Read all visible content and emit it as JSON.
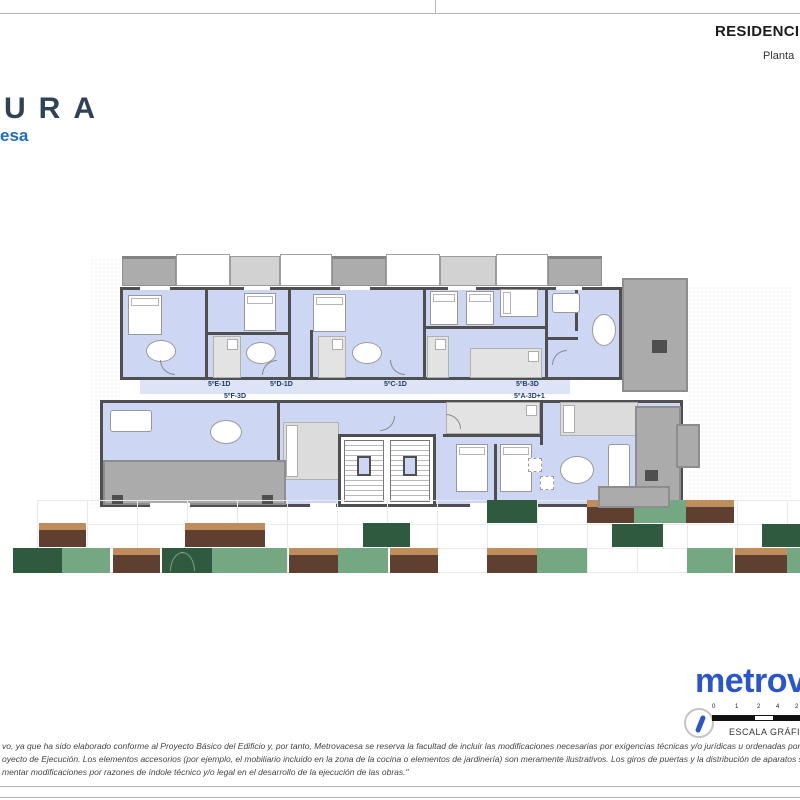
{
  "header": {
    "title": "RESIDENCIAL",
    "subtitle": "Planta"
  },
  "project_logo": {
    "wordmark_fragment": "URA",
    "sub_fragment": "esa"
  },
  "floorplan": {
    "labels": [
      {
        "text": "5ºE-1D",
        "x": 208,
        "y": 381
      },
      {
        "text": "5ºD-1D",
        "x": 270,
        "y": 381
      },
      {
        "text": "5ºC-1D",
        "x": 384,
        "y": 381
      },
      {
        "text": "5ºB-3D",
        "x": 516,
        "y": 381
      },
      {
        "text": "5ºF-3D",
        "x": 224,
        "y": 393
      },
      {
        "text": "5ºA-3D+1",
        "x": 514,
        "y": 393
      }
    ]
  },
  "garden": {
    "blocks": [
      {
        "x": 487,
        "y": 500,
        "w": 50,
        "h": 23,
        "type": "dark"
      },
      {
        "x": 587,
        "y": 500,
        "w": 47,
        "h": 23,
        "type": "brown"
      },
      {
        "x": 634,
        "y": 500,
        "w": 52,
        "h": 23,
        "type": "mid"
      },
      {
        "x": 686,
        "y": 500,
        "w": 48,
        "h": 23,
        "type": "brown"
      },
      {
        "x": 39,
        "y": 523,
        "w": 47,
        "h": 24,
        "type": "brown"
      },
      {
        "x": 185,
        "y": 523,
        "w": 80,
        "h": 24,
        "type": "brown"
      },
      {
        "x": 363,
        "y": 523,
        "w": 47,
        "h": 24,
        "type": "dark"
      },
      {
        "x": 612,
        "y": 524,
        "w": 51,
        "h": 23,
        "type": "dark"
      },
      {
        "x": 762,
        "y": 524,
        "w": 38,
        "h": 23,
        "type": "dark"
      },
      {
        "x": 13,
        "y": 548,
        "w": 49,
        "h": 25,
        "type": "dark"
      },
      {
        "x": 62,
        "y": 548,
        "w": 48,
        "h": 25,
        "type": "mid"
      },
      {
        "x": 113,
        "y": 548,
        "w": 47,
        "h": 25,
        "type": "brown"
      },
      {
        "x": 162,
        "y": 548,
        "w": 50,
        "h": 25,
        "type": "dark",
        "leaf": true
      },
      {
        "x": 212,
        "y": 548,
        "w": 75,
        "h": 25,
        "type": "mid"
      },
      {
        "x": 289,
        "y": 548,
        "w": 49,
        "h": 25,
        "type": "brown"
      },
      {
        "x": 338,
        "y": 548,
        "w": 50,
        "h": 25,
        "type": "mid"
      },
      {
        "x": 390,
        "y": 548,
        "w": 48,
        "h": 25,
        "type": "brown"
      },
      {
        "x": 487,
        "y": 548,
        "w": 50,
        "h": 25,
        "type": "brown"
      },
      {
        "x": 537,
        "y": 548,
        "w": 50,
        "h": 25,
        "type": "mid"
      },
      {
        "x": 687,
        "y": 548,
        "w": 46,
        "h": 25,
        "type": "mid"
      },
      {
        "x": 735,
        "y": 548,
        "w": 52,
        "h": 25,
        "type": "brown"
      },
      {
        "x": 787,
        "y": 548,
        "w": 13,
        "h": 25,
        "type": "mid"
      }
    ]
  },
  "brand": {
    "wordmark": "metrova"
  },
  "scale_bar": {
    "title": "ESCALA GRÁFICA",
    "ticks": [
      "0",
      "1",
      "2",
      "4",
      "2"
    ],
    "tick_offsets": [
      0,
      23,
      45,
      64,
      83
    ]
  },
  "icons": {
    "north_arrow": "north-arrow-icon"
  },
  "disclaimer": {
    "lines": [
      "vo, ya que ha sido elaborado conforme al Proyecto Básico del Edificio y, por tanto, Metrovacesa se reserva la facultad de incluir las modificaciones necesarias por exigencias técnicas y/o jurídicas u ordenadas por cualesquiera administraciones u",
      "oyecto de Ejecución. Los elementos accesorios (por ejemplo, el mobiliario incluido en la zona de la cocina o elementos de jardinería) son meramente ilustrativos. Los giros de puertas y la distribución de aparatos sanitarios no son vinculantes. Las",
      "mentar modificaciones por razones de índole técnico y/o legal en el desarrollo de la ejecución de las obras.\""
    ]
  },
  "colors": {
    "room_fill": "#cdd7f3",
    "wall": "#4f4f4f",
    "terrace_gray": "#ababab",
    "balcony_gray": "#acacac",
    "dark_green": "#2f5a40",
    "medium_green": "#74a883",
    "planter_brown": "#5f4030",
    "planter_tan": "#bf8d5c",
    "brand_blue": "#2b55cc",
    "logo_navy": "#2f4256",
    "logo_blue": "#1e6bc0",
    "label_navy": "#1d3a6b"
  }
}
